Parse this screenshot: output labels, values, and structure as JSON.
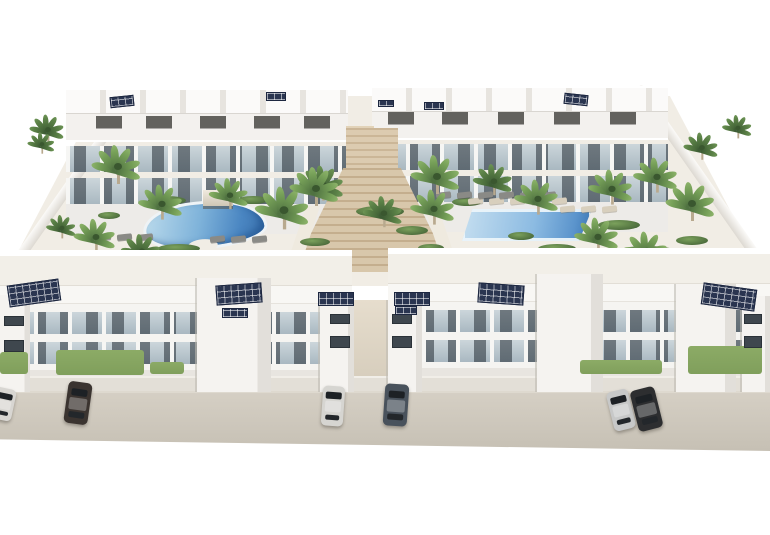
{
  "image": {
    "type": "3d-architectural-render",
    "subject": "white modern apartment complex with rooftop solar panels, two swimming pools, palm trees, central staircase and street parking"
  },
  "palette": {
    "background": "#ffffff",
    "building_white": "#f5f4f1",
    "glass_balcony": "#aebbc2",
    "window_dark": "#3f474e",
    "solar_navy": "#2a3550",
    "pool_light": "#bcdbec",
    "pool_deep": "#3a70ac",
    "stairs_tan": "#cdb899",
    "courtyard": "#f1ede5",
    "road": "#cbc5b9",
    "palm_green": "#76a058",
    "grass_green": "#83a15e"
  },
  "scene": {
    "palms": [
      [
        48,
        132,
        0.7,
        "d"
      ],
      [
        118,
        170,
        1.0,
        "l"
      ],
      [
        162,
        207,
        0.9,
        "l"
      ],
      [
        96,
        240,
        0.85,
        "l"
      ],
      [
        142,
        254,
        0.8,
        "d"
      ],
      [
        230,
        198,
        0.8,
        "l"
      ],
      [
        284,
        214,
        1.1,
        "l"
      ],
      [
        323,
        188,
        0.9,
        "d"
      ],
      [
        62,
        230,
        0.6,
        "d"
      ],
      [
        42,
        146,
        0.55,
        "d"
      ],
      [
        316,
        192,
        1.0,
        "l"
      ],
      [
        437,
        180,
        1.0,
        "l"
      ],
      [
        384,
        216,
        0.8,
        "d"
      ],
      [
        434,
        212,
        0.9,
        "l"
      ],
      [
        494,
        184,
        0.8,
        "d"
      ],
      [
        538,
        202,
        0.9,
        "l"
      ],
      [
        612,
        192,
        0.9,
        "l"
      ],
      [
        657,
        180,
        0.9,
        "l"
      ],
      [
        692,
        207,
        1.0,
        "l"
      ],
      [
        598,
        240,
        0.9,
        "l"
      ],
      [
        647,
        254,
        0.9,
        "l"
      ],
      [
        702,
        150,
        0.7,
        "d"
      ],
      [
        738,
        130,
        0.6,
        "d"
      ],
      [
        198,
        344,
        0.6,
        "l"
      ],
      [
        84,
        354,
        0.55,
        "l"
      ],
      [
        498,
        358,
        0.65,
        "l"
      ],
      [
        548,
        364,
        0.7,
        "l"
      ],
      [
        614,
        358,
        0.6,
        "l"
      ],
      [
        760,
        352,
        0.85,
        "l"
      ]
    ],
    "shrubs": [
      [
        148,
        196,
        38,
        9
      ],
      [
        238,
        196,
        30,
        8
      ],
      [
        158,
        244,
        42,
        9
      ],
      [
        356,
        206,
        48,
        11
      ],
      [
        396,
        226,
        32,
        9
      ],
      [
        452,
        198,
        30,
        8
      ],
      [
        598,
        220,
        42,
        10
      ],
      [
        618,
        246,
        58,
        11
      ],
      [
        538,
        244,
        38,
        9
      ],
      [
        676,
        236,
        32,
        9
      ],
      [
        98,
        212,
        22,
        7
      ],
      [
        508,
        232,
        26,
        8
      ],
      [
        300,
        238,
        30,
        8
      ],
      [
        418,
        244,
        26,
        8
      ],
      [
        540,
        370,
        42,
        9
      ],
      [
        586,
        372,
        38,
        9
      ],
      [
        640,
        370,
        32,
        8
      ],
      [
        298,
        372,
        28,
        7
      ],
      [
        428,
        372,
        28,
        7
      ],
      [
        58,
        370,
        22,
        7
      ],
      [
        718,
        368,
        30,
        8
      ]
    ],
    "grass": [
      [
        56,
        350,
        88,
        25
      ],
      [
        0,
        352,
        28,
        22
      ],
      [
        688,
        346,
        74,
        28
      ],
      [
        580,
        360,
        82,
        14
      ],
      [
        150,
        362,
        34,
        12
      ]
    ],
    "solar": [
      [
        8,
        282,
        52,
        22,
        -8
      ],
      [
        216,
        284,
        46,
        20,
        -4
      ],
      [
        318,
        292,
        36,
        14,
        0
      ],
      [
        222,
        308,
        26,
        10,
        0
      ],
      [
        394,
        292,
        36,
        14,
        0
      ],
      [
        395,
        306,
        22,
        9,
        0
      ],
      [
        478,
        284,
        46,
        20,
        4
      ],
      [
        702,
        286,
        54,
        22,
        8
      ],
      [
        110,
        96,
        24,
        11,
        -6
      ],
      [
        266,
        92,
        20,
        9,
        0
      ],
      [
        424,
        102,
        20,
        8,
        0
      ],
      [
        564,
        94,
        24,
        11,
        6
      ],
      [
        378,
        100,
        16,
        7,
        0
      ]
    ],
    "furniture": {
      "front_beige": {
        "y": 260,
        "xs": [
          20,
          86,
          156,
          226,
          296
        ],
        "y2": 258,
        "xs2": [
          424,
          490,
          558,
          626,
          698
        ],
        "w": 30,
        "h": 16
      },
      "rear_dark": {
        "y": 116,
        "xs": [
          96,
          146,
          200,
          254,
          304
        ],
        "y2": 112,
        "xs2": [
          388,
          442,
          498,
          554,
          610
        ],
        "w": 26,
        "h": 12
      }
    },
    "loungers": [
      {
        "x": 468,
        "y": 198,
        "n": 5,
        "c": "beige"
      },
      {
        "x": 436,
        "y": 192,
        "n": 6,
        "c": "dark"
      },
      {
        "x": 96,
        "y": 234,
        "n": 3,
        "c": "dark"
      },
      {
        "x": 210,
        "y": 236,
        "n": 3,
        "c": "dark"
      },
      {
        "x": 560,
        "y": 206,
        "n": 3,
        "c": "beige"
      }
    ],
    "cars": [
      {
        "x": -8,
        "y": 388,
        "w": 22,
        "h": 32,
        "r": 12,
        "body": "#d8d6d2"
      },
      {
        "x": 66,
        "y": 382,
        "w": 24,
        "h": 42,
        "r": 8,
        "body": "#3b3430"
      },
      {
        "x": 322,
        "y": 386,
        "w": 22,
        "h": 40,
        "r": 4,
        "body": "#d6d5d1"
      },
      {
        "x": 384,
        "y": 384,
        "w": 24,
        "h": 42,
        "r": 4,
        "body": "#49525c"
      },
      {
        "x": 610,
        "y": 390,
        "w": 22,
        "h": 40,
        "r": -14,
        "body": "#c7c8c8"
      },
      {
        "x": 634,
        "y": 388,
        "w": 25,
        "h": 42,
        "r": -14,
        "body": "#2d2e30"
      }
    ],
    "windows": [
      [
        330,
        314,
        20,
        10
      ],
      [
        330,
        336,
        20,
        12
      ],
      [
        392,
        314,
        20,
        10
      ],
      [
        392,
        336,
        20,
        12
      ],
      [
        4,
        316,
        20,
        10
      ],
      [
        4,
        340,
        20,
        12
      ],
      [
        744,
        314,
        18,
        10
      ],
      [
        744,
        336,
        18,
        12
      ]
    ],
    "towers": [
      [
        197,
        278,
        74,
        114
      ],
      [
        320,
        300,
        34,
        92
      ],
      [
        388,
        300,
        34,
        92
      ],
      [
        537,
        274,
        66,
        118
      ],
      [
        676,
        284,
        60,
        108
      ],
      [
        0,
        295,
        30,
        97
      ],
      [
        742,
        296,
        28,
        96
      ]
    ]
  }
}
